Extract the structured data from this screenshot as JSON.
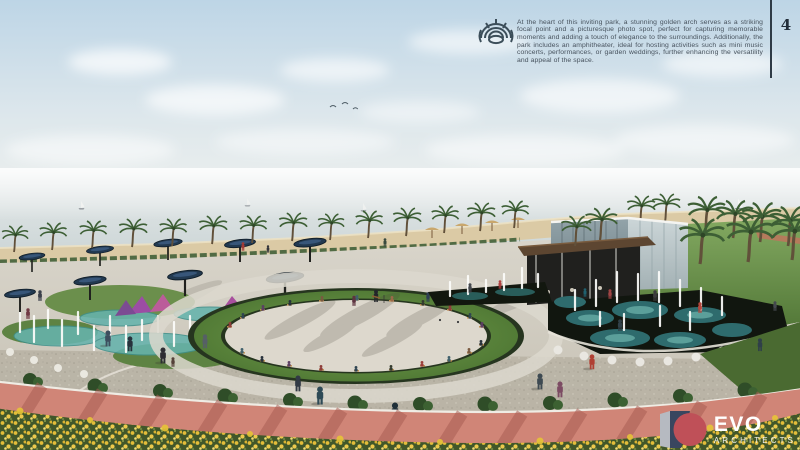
{
  "header": {
    "icon": "amphitheater-icon",
    "description": "At the heart of this inviting park, a stunning golden arch serves as a striking focal point and a picturesque photo spot, perfect for capturing memorable moments and adding a touch of elegance to the surroundings. Additionally, the park includes an amphitheater, ideal for hosting activities such as mini music concerts, performances, or garden weddings, further enhancing the versatility and appeal of the space.",
    "page_number": "4"
  },
  "footer_logo": {
    "brand": "EVO",
    "tagline": "ARCHITECTS",
    "mark_colors": {
      "navy": "#39465f",
      "red": "#bf5058",
      "gray": "#b6bac1"
    }
  },
  "scene": {
    "type": "architectural-render",
    "subject": "beachfront park with elliptical lawn amphitheater, splash fountains, shade canopies, glass pavilion, palm trees, red jogging track and yellow flower bed along the sea"
  }
}
